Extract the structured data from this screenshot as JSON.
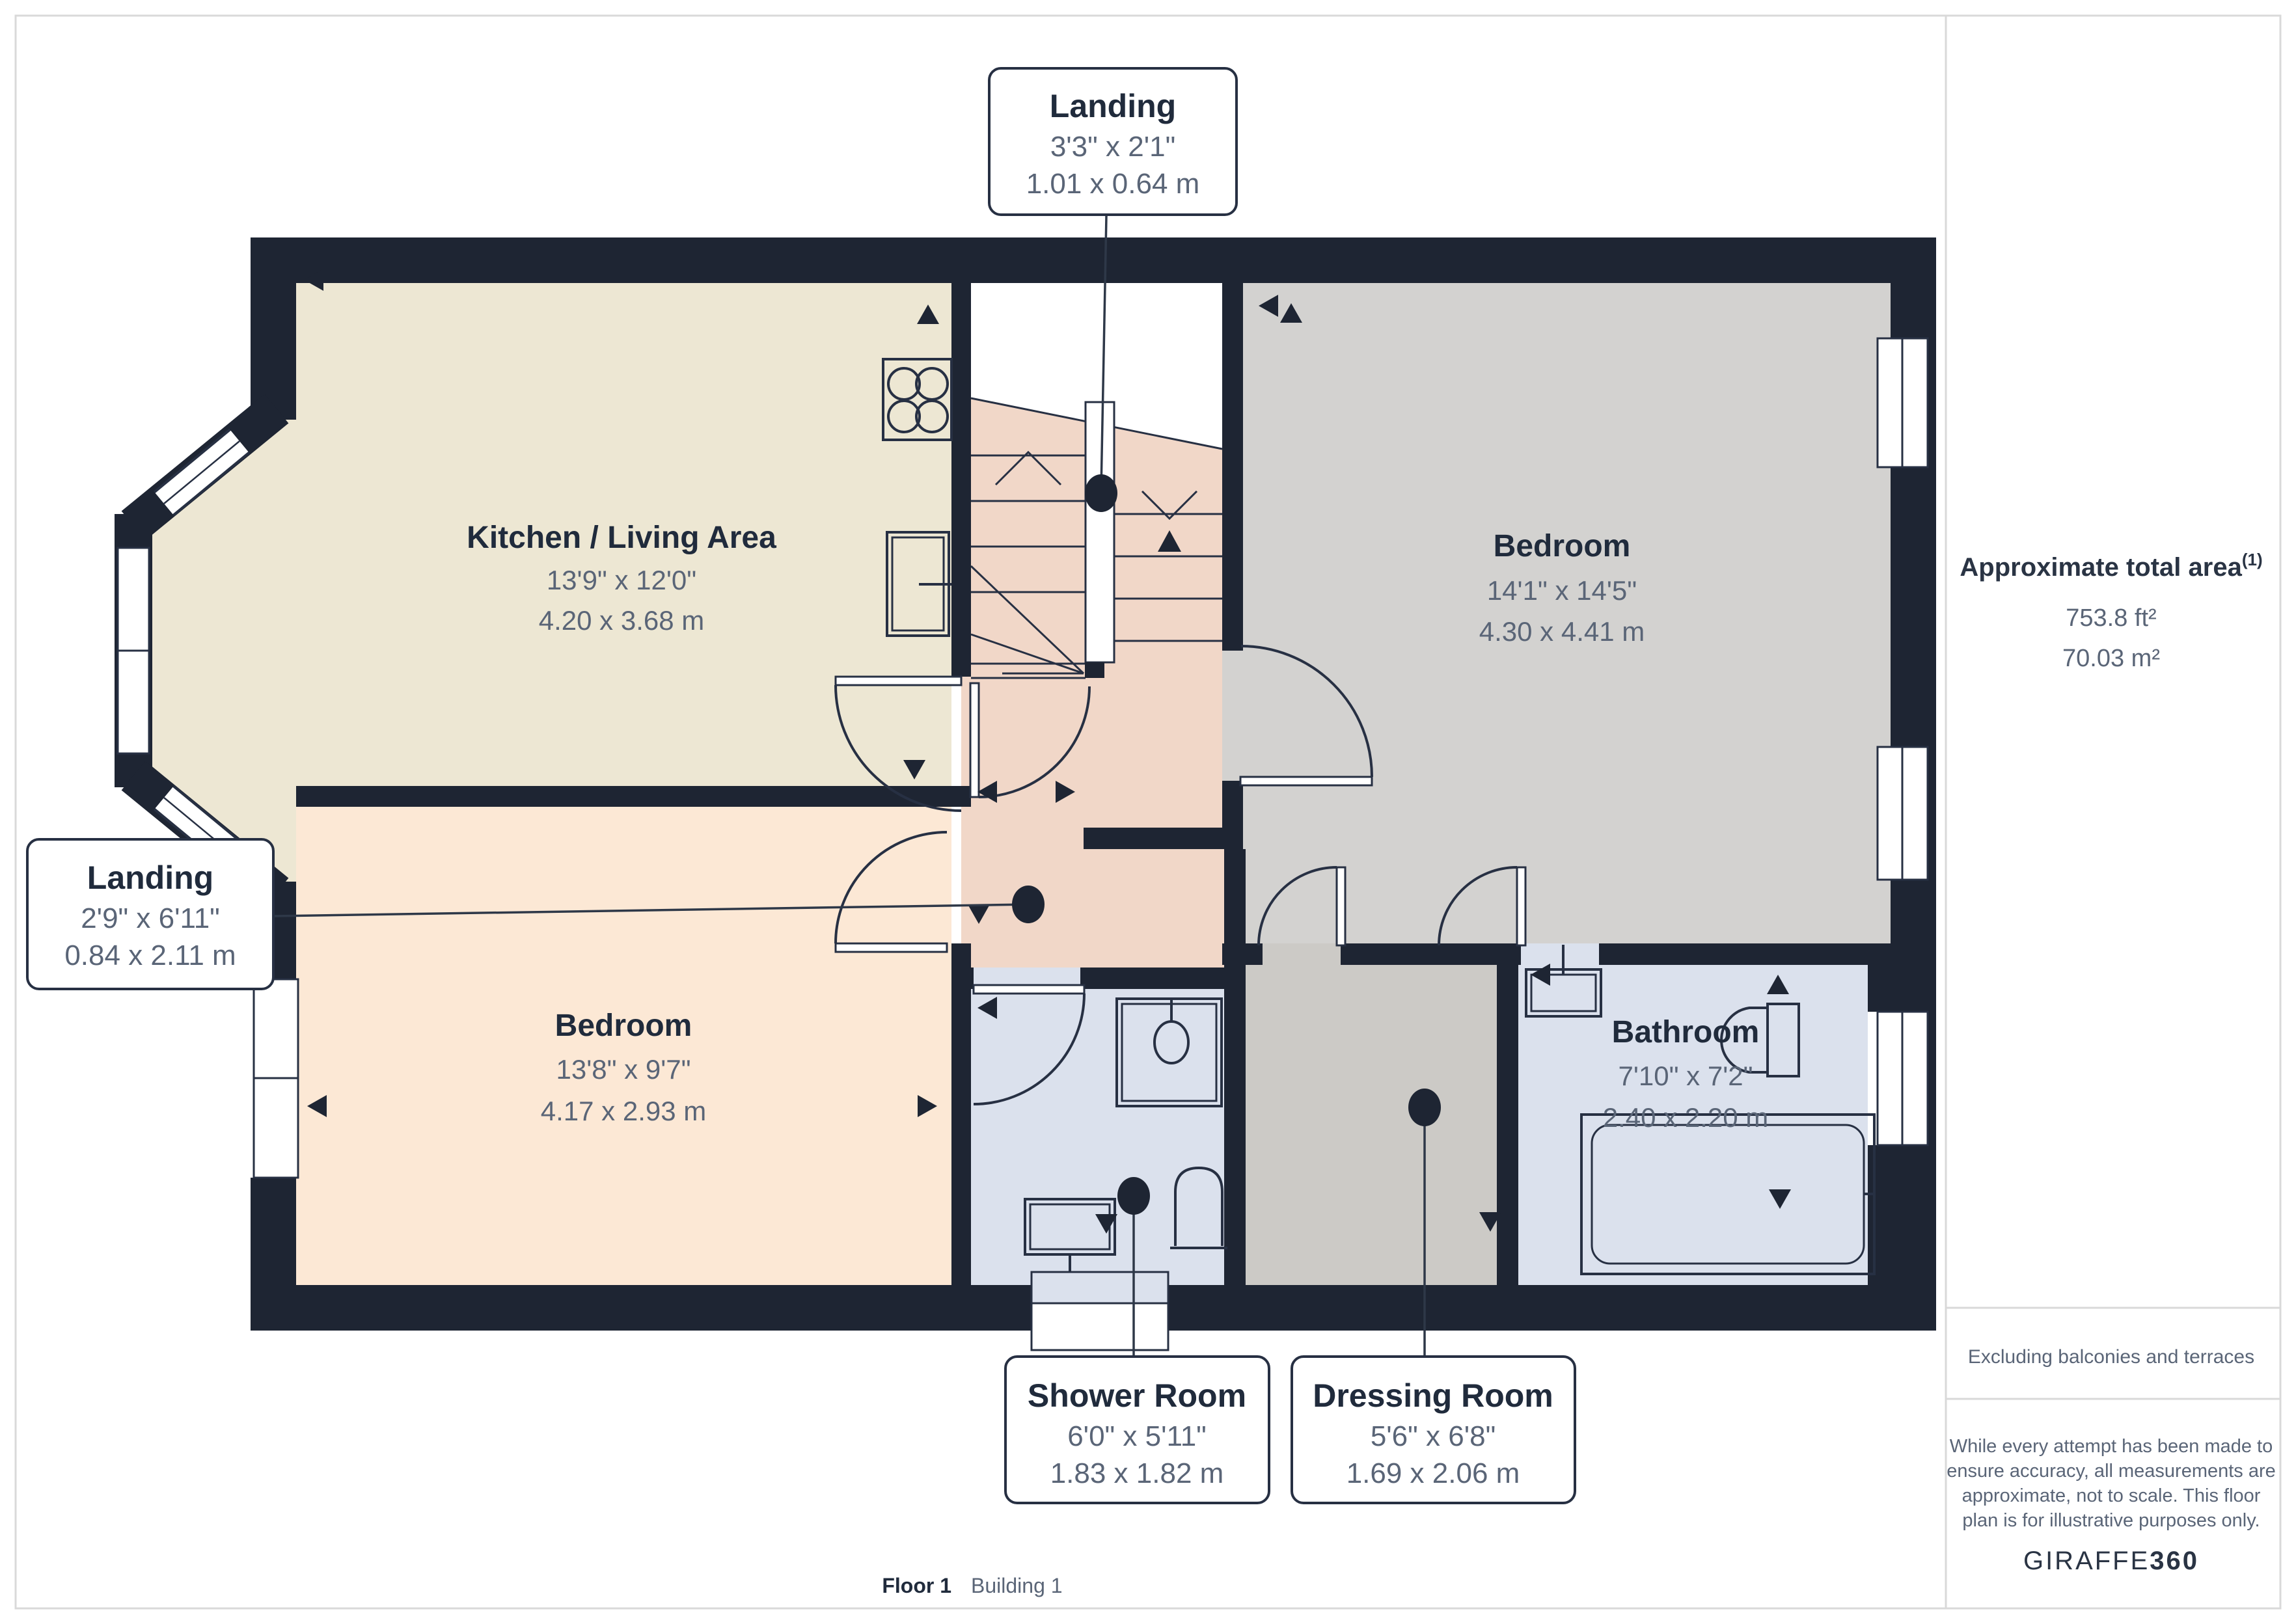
{
  "callouts": {
    "landing_top": {
      "name": "Landing",
      "imperial": "3'3\" x 2'1\"",
      "metric": "1.01 x 0.64 m"
    },
    "landing_left": {
      "name": "Landing",
      "imperial": "2'9\" x 6'11\"",
      "metric": "0.84 x 2.11 m"
    },
    "shower": {
      "name": "Shower Room",
      "imperial": "6'0\" x 5'11\"",
      "metric": "1.83 x 1.82 m"
    },
    "dressing": {
      "name": "Dressing Room",
      "imperial": "5'6\" x 6'8\"",
      "metric": "1.69 x 2.06 m"
    }
  },
  "rooms": {
    "kitchen": {
      "name": "Kitchen / Living Area",
      "imperial": "13'9\" x 12'0\"",
      "metric": "4.20 x 3.68 m"
    },
    "bedroom_right": {
      "name": "Bedroom",
      "imperial": "14'1\" x 14'5\"",
      "metric": "4.30 x 4.41 m"
    },
    "bedroom_left": {
      "name": "Bedroom",
      "imperial": "13'8\" x 9'7\"",
      "metric": "4.17 x 2.93 m"
    },
    "bathroom": {
      "name": "Bathroom",
      "imperial": "7'10\" x 7'2\"",
      "metric": "2.40 x 2.20 m"
    }
  },
  "sidebar": {
    "title": "Approximate total area",
    "title_sup": "(1)",
    "area_ft": "753.8 ft²",
    "area_m": "70.03 m²",
    "excluding": "Excluding balconies and terraces",
    "disclaimer": [
      "While every attempt has been made to",
      "ensure accuracy, all measurements are",
      "approximate, not to scale. This floor",
      "plan is for illustrative purposes only."
    ],
    "logo": "GIRAFFE",
    "logo_suffix": "360"
  },
  "footer": {
    "floor": "Floor 1",
    "building": "Building 1"
  },
  "colors": {
    "wall": "#1E2533",
    "kitchen_floor": "#EDE7D3",
    "bedroom_left_floor": "#FCE8D5",
    "landing_floor": "#F1D7C8",
    "bedroom_right_floor": "#D3D2D0",
    "dressing_floor": "#CCCAC6",
    "wet_room_floor": "#DBE1ED",
    "text_dark": "#202B3C",
    "text_dim": "#5A6577",
    "line": "#273043",
    "page_border": "#D9D9D9"
  }
}
